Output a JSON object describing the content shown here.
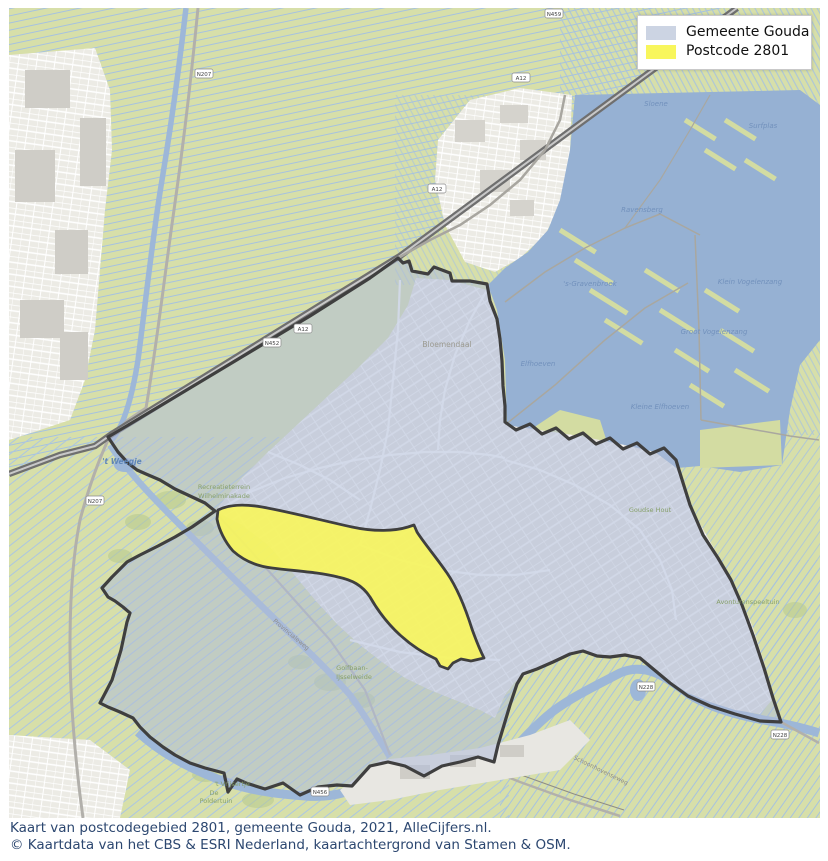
{
  "legend": {
    "items": [
      {
        "label": "Gemeente Gouda",
        "color": "#ccd4e3"
      },
      {
        "label": "Postcode 2801",
        "color": "#f8f65c"
      }
    ]
  },
  "caption": {
    "line1": "Kaart van postcodegebied 2801, gemeente Gouda, 2021, AlleCijfers.nl.",
    "line2": "© Kaartdata van het CBS & ESRI Nederland, kaartachtergrond van Stamen & OSM."
  },
  "colors": {
    "gemeente_fill": "#ccd4e3",
    "postcode_fill": "#f8f65c",
    "boundary": "#3f3f3f",
    "water": "#96b1d3",
    "field": "#d7dfa9",
    "caption_text": "#2c4770"
  },
  "map": {
    "labels": [
      {
        "text": "Bloemendaal",
        "x": 447,
        "y": 347,
        "cls": "lbl-gray"
      },
      {
        "text": "'t Weegje",
        "x": 122,
        "y": 464,
        "cls": "lbl-blue-bold"
      },
      {
        "text": "Recreatieterrein",
        "x": 224,
        "y": 489,
        "cls": "lbl-green"
      },
      {
        "text": "Wilhelminakade",
        "x": 224,
        "y": 498,
        "cls": "lbl-green"
      },
      {
        "text": "Sloene",
        "x": 656,
        "y": 106,
        "cls": "lbl-blue"
      },
      {
        "text": "Surfplas",
        "x": 763,
        "y": 128,
        "cls": "lbl-blue"
      },
      {
        "text": "Ravensberg",
        "x": 642,
        "y": 212,
        "cls": "lbl-blue"
      },
      {
        "text": "'s-Gravenbroek",
        "x": 590,
        "y": 286,
        "cls": "lbl-blue"
      },
      {
        "text": "Elfhoeven",
        "x": 538,
        "y": 366,
        "cls": "lbl-blue"
      },
      {
        "text": "Klein Vogelenzang",
        "x": 750,
        "y": 284,
        "cls": "lbl-blue"
      },
      {
        "text": "Groot Vogelenzang",
        "x": 714,
        "y": 334,
        "cls": "lbl-blue"
      },
      {
        "text": "Kleine Elfhoeven",
        "x": 660,
        "y": 409,
        "cls": "lbl-blue"
      },
      {
        "text": "Goudse Hout",
        "x": 650,
        "y": 512,
        "cls": "lbl-green"
      },
      {
        "text": "Avonturenspeeltuin",
        "x": 748,
        "y": 604,
        "cls": "lbl-green"
      },
      {
        "text": "Golfbaan-",
        "x": 352,
        "y": 670,
        "cls": "lbl-green"
      },
      {
        "text": "IJsselweide",
        "x": 354,
        "y": 679,
        "cls": "lbl-green"
      },
      {
        "text": "'t Vrijsertje",
        "x": 232,
        "y": 786,
        "cls": "lbl-green"
      },
      {
        "text": "De",
        "x": 214,
        "y": 795,
        "cls": "lbl-green"
      },
      {
        "text": "Poldertuin",
        "x": 216,
        "y": 803,
        "cls": "lbl-green"
      },
      {
        "text": "Provincialeweg",
        "x": 290,
        "y": 636,
        "cls": "lbl-road",
        "rot": 40
      },
      {
        "text": "Schoonhovenseweg",
        "x": 600,
        "y": 772,
        "cls": "lbl-road",
        "rot": 26
      }
    ],
    "shields": [
      {
        "text": "A12",
        "x": 303,
        "y": 329
      },
      {
        "text": "A12",
        "x": 437,
        "y": 189
      },
      {
        "text": "A12",
        "x": 521,
        "y": 78
      },
      {
        "text": "N459",
        "x": 554,
        "y": 14
      },
      {
        "text": "N452",
        "x": 272,
        "y": 343
      },
      {
        "text": "N207",
        "x": 204,
        "y": 74
      },
      {
        "text": "N207",
        "x": 95,
        "y": 501
      },
      {
        "text": "N228",
        "x": 646,
        "y": 687
      },
      {
        "text": "N228",
        "x": 780,
        "y": 735
      },
      {
        "text": "N456",
        "x": 320,
        "y": 792
      }
    ]
  }
}
